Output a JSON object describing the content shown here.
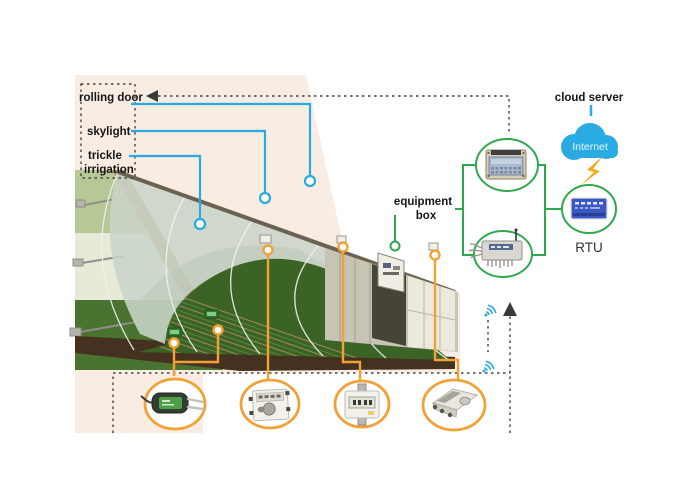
{
  "labels": {
    "rolling_door": "rolling door",
    "skylight": "skylight",
    "trickle_line1": "trickle",
    "trickle_line2": "irrigation",
    "equipment_line1": "equipment",
    "equipment_line2": "box",
    "cloud_server": "cloud server",
    "internet": "Internet",
    "rtu": "RTU"
  },
  "icons": {
    "wifi": "wifi-signal-icon",
    "cloud": "internet-cloud-icon",
    "lightning": "lightning-bolt-icon",
    "up_arrow": "up-arrow-icon",
    "left_arrow": "left-arrow-icon"
  },
  "colors": {
    "panel_background": "#f9ece3",
    "blue": "#29abe2",
    "orange": "#f2a136",
    "green": "#2fa84f",
    "dashed": "#454545",
    "arrow_fill": "#3a3a3a",
    "cloud": "#29abe2",
    "lightning": "#f7a61e",
    "rtu_device": "#3a57c4",
    "text": "#161616"
  }
}
